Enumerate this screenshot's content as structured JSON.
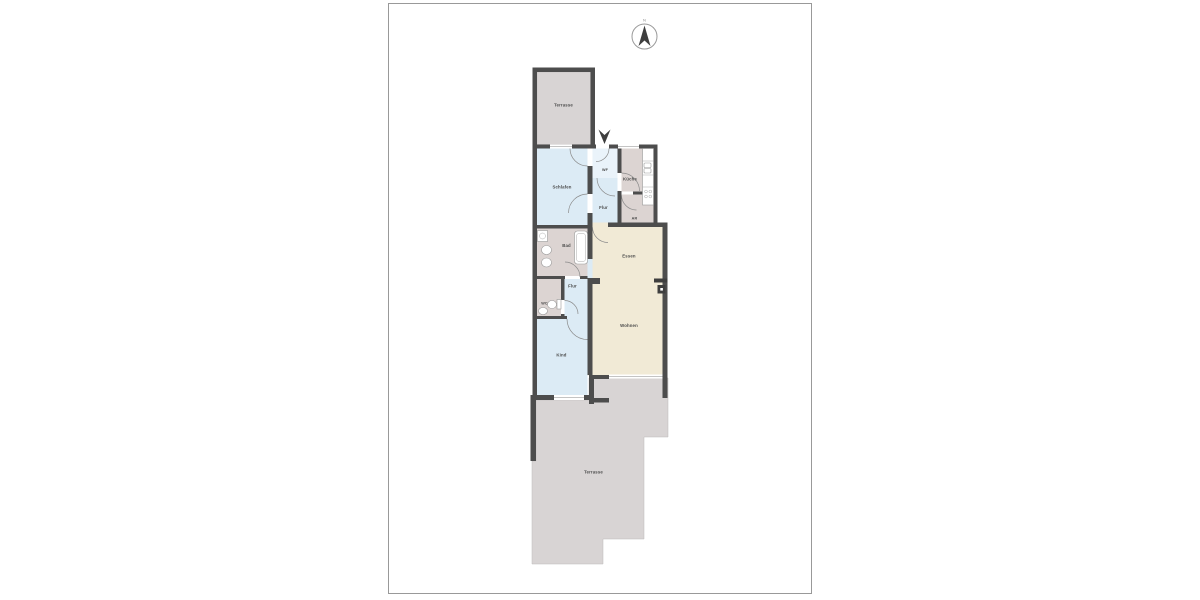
{
  "compass": {
    "north_label": "N"
  },
  "floor_plan": {
    "labels": {
      "terrace_top": "Terrasse",
      "schlafen": "Schlafen",
      "windfang": "WF",
      "kueche": "Küche",
      "flur_upper": "Flur",
      "abstellraum": "AR",
      "bad": "Bad",
      "essen": "Essen",
      "flur_lower": "Flur",
      "wc": "WC",
      "kind": "Kind",
      "wohnen": "Wohnen",
      "terrace_bottom": "Terrasse"
    },
    "colors": {
      "wall": "#4d4d4d",
      "room_blue": "#dcebf5",
      "room_blue_light": "#eaf3fa",
      "room_service": "#dcd4d2",
      "room_living": "#f1ead6",
      "terrace": "#d8d4d4",
      "label_text": "#4a4a4a",
      "page_border": "#999999"
    }
  }
}
